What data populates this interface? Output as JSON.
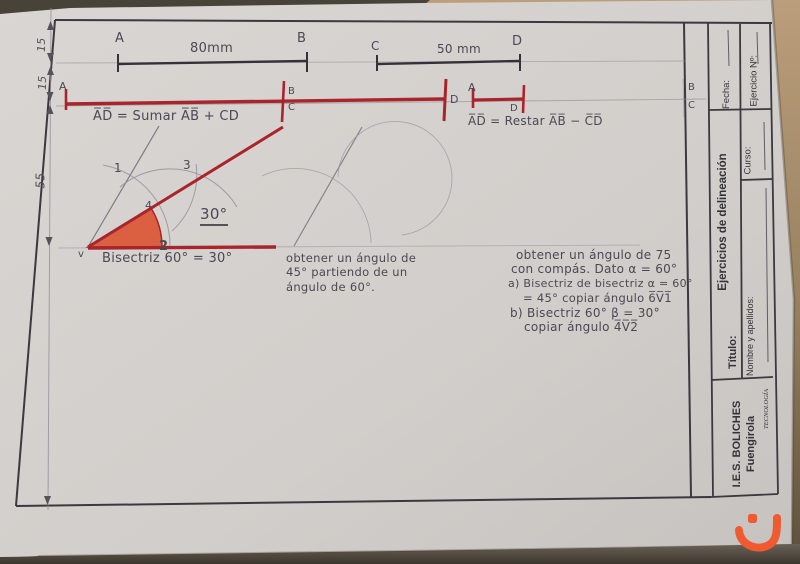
{
  "sheet": {
    "dims": {
      "d1": "15",
      "d2": "15",
      "d3": "55"
    },
    "top_row": {
      "a": "A",
      "ab_len": "80mm",
      "b": "B",
      "c": "C",
      "cd_len": "50 mm",
      "d": "D"
    },
    "sum_row": {
      "a": "A",
      "b": "B",
      "c": "C",
      "d": "D",
      "caption": "A̅D̅ = Sumar A̅B̅ + CD"
    },
    "rest_row": {
      "a": "A",
      "d": "D",
      "caption": "A̅D̅ = Restar A̅B̅ − C̅D̅"
    },
    "bisector": {
      "p1": "1",
      "p2": "2",
      "p3": "3",
      "p4": "4",
      "v": "v",
      "angle": "30°",
      "caption": "Bisectriz 60° = 30°"
    },
    "mid_note": {
      "l1": "obtener un ángulo de",
      "l2": "45° partiendo de un",
      "l3": "ángulo de 60°."
    },
    "right_note": {
      "l1": "obtener un ángulo de 75",
      "l2": "con compás. Dato α = 60°",
      "l3": "a) Bisectriz de bisectriz α = 60°",
      "l4": "= 45° copiar ángulo 6̅V̅1̅",
      "l5": "b) Bisectriz 60° β = 30°",
      "l6": "copiar ángulo 4̅V̅2̅"
    },
    "margin": {
      "b": "B",
      "c": "C"
    }
  },
  "title_block": {
    "fecha": "Fecha:",
    "ejercicio": "Ejercicio Nº:",
    "curso": "Curso:",
    "title": "Ejercicios de delineación",
    "titulo": "Título:",
    "nombre": "Nombre y apellidos:",
    "school1": "I.E.S. BOLICHES",
    "school2": "Fuengirola",
    "dept": "TECNOLOGÍA"
  },
  "colors": {
    "red": "#a9242b",
    "wedge": "#dc4f2e",
    "pencil": "#8e8b95",
    "ink": "#33323a",
    "watermark": "#ef5a31"
  }
}
